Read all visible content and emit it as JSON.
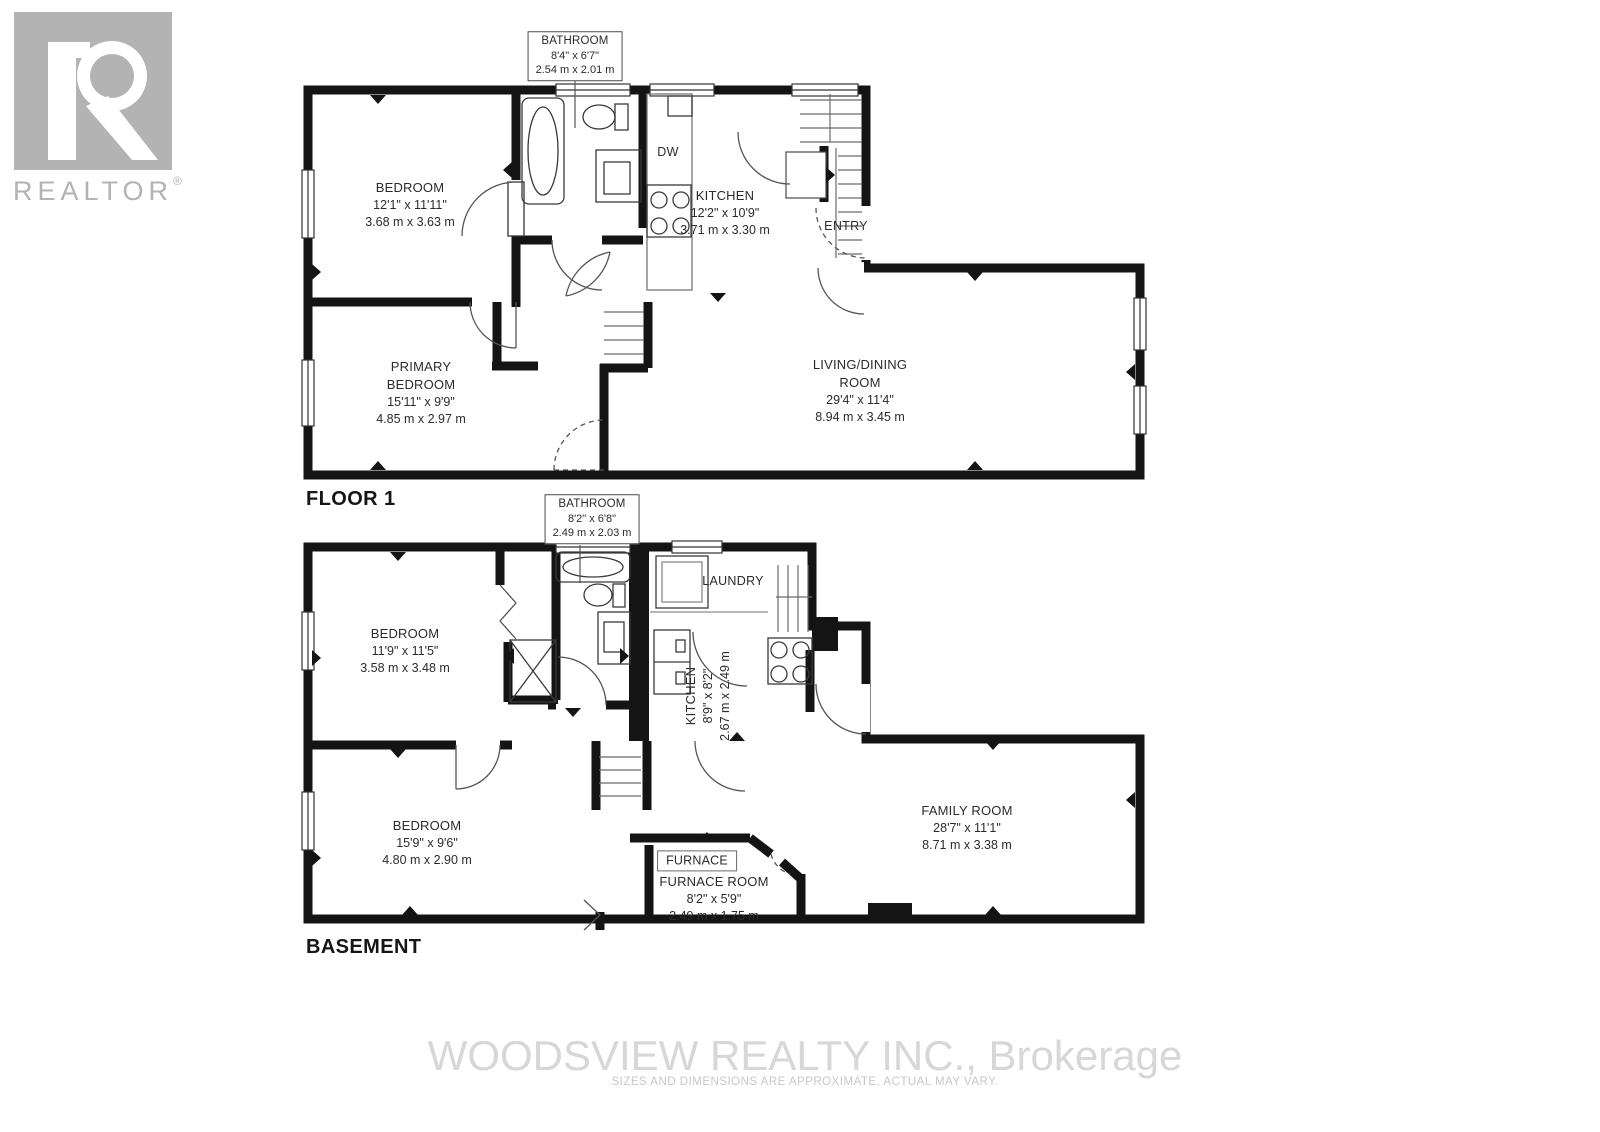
{
  "branding": {
    "logo_text": "REALTOR",
    "logo_reg": "®"
  },
  "floor1": {
    "label": "FLOOR 1",
    "bathroom": {
      "name": "BATHROOM",
      "imperial": "8'4\" x 6'7\"",
      "metric": "2.54 m x 2.01 m"
    },
    "bedroom": {
      "name": "BEDROOM",
      "imperial": "12'1\" x 11'11\"",
      "metric": "3.68 m x 3.63 m"
    },
    "kitchen": {
      "name": "KITCHEN",
      "imperial": "12'2\" x 10'9\"",
      "metric": "3.71 m x 3.30 m"
    },
    "dw": "DW",
    "entry": "ENTRY",
    "primary_bedroom": {
      "name1": "PRIMARY",
      "name2": "BEDROOM",
      "imperial": "15'11\" x 9'9\"",
      "metric": "4.85 m x 2.97 m"
    },
    "living_dining": {
      "name1": "LIVING/DINING",
      "name2": "ROOM",
      "imperial": "29'4\" x 11'4\"",
      "metric": "8.94 m x 3.45 m"
    }
  },
  "basement": {
    "label": "BASEMENT",
    "bathroom": {
      "name": "BATHROOM",
      "imperial": "8'2\" x 6'8\"",
      "metric": "2.49 m x 2.03 m"
    },
    "laundry": "LAUNDRY",
    "bedroom1": {
      "name": "BEDROOM",
      "imperial": "11'9\" x 11'5\"",
      "metric": "3.58 m x 3.48 m"
    },
    "kitchen": {
      "name": "KITCHEN",
      "imperial": "8'9\" x 8'2\"",
      "metric": "2.67 m x 2.49 m"
    },
    "family_room": {
      "name": "FAMILY ROOM",
      "imperial": "28'7\" x 11'1\"",
      "metric": "8.71 m x 3.38 m"
    },
    "furnace_label": "FURNACE",
    "furnace_room": {
      "name": "FURNACE ROOM",
      "imperial": "8'2\" x 5'9\"",
      "metric": "2.49 m x 1.75 m"
    },
    "bedroom2": {
      "name": "BEDROOM",
      "imperial": "15'9\" x 9'6\"",
      "metric": "4.80 m x 2.90 m"
    }
  },
  "footer": {
    "brokerage": "WOODSVIEW REALTY INC., Brokerage",
    "disclaimer": "SIZES AND DIMENSIONS ARE APPROXIMATE, ACTUAL MAY VARY."
  },
  "colors": {
    "wall": "#141414",
    "label_text": "#2b2b2b",
    "logo_gray": "#b3b3b3",
    "watermark": "#d7d7d7"
  }
}
